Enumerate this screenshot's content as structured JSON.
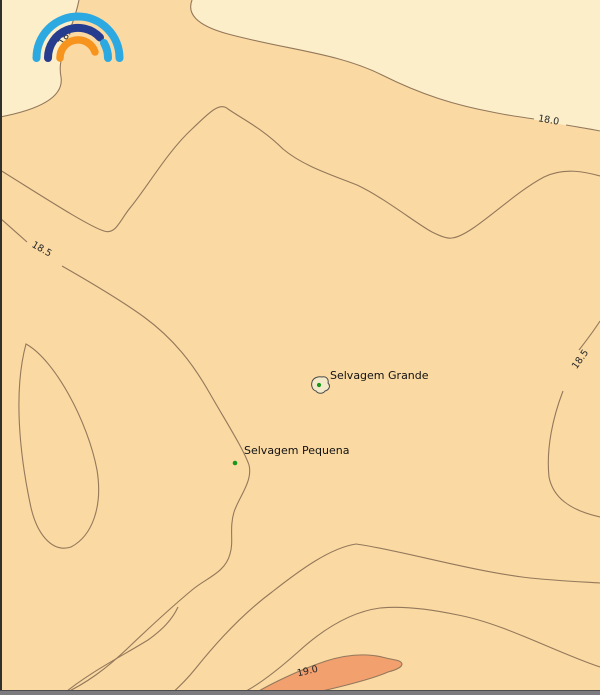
{
  "colors": {
    "band_below_18": "#FBEEC8",
    "band_18_19": "#FAD9A2",
    "band_above_19": "#F1A06E",
    "contour_line": "#93785B",
    "bottom_bar": "#7B7B80",
    "logo_cyan": "#2DA9E1",
    "logo_blue": "#263C8F",
    "logo_orange": "#F7941D",
    "place_dot_green": "#18991B"
  },
  "labels": {
    "contour": [
      {
        "value": "18.0",
        "location": "top-left, partially hidden behind logo"
      },
      {
        "value": "18.0",
        "location": "top-right"
      },
      {
        "value": "18.5",
        "location": "upper-left"
      },
      {
        "value": "18.5",
        "location": "right-edge"
      },
      {
        "value": "19.0",
        "location": "bottom"
      }
    ],
    "places": [
      {
        "name": "Selvagem Grande"
      },
      {
        "name": "Selvagem Pequena"
      }
    ]
  },
  "chart_data": {
    "type": "contour-map",
    "contour_levels": [
      18.0,
      18.5,
      19.0
    ],
    "bands": [
      {
        "range": "below 18.0",
        "color": "#FBEEC8"
      },
      {
        "range": "18.0 to 19.0",
        "color": "#FAD9A2"
      },
      {
        "range": "above 19.0",
        "color": "#F1A06E"
      }
    ],
    "places": [
      {
        "name": "Selvagem Grande",
        "marker": "island-outline-with-green-dot"
      },
      {
        "name": "Selvagem Pequena",
        "marker": "green-dot"
      }
    ]
  },
  "icons": {
    "logo": "rainbow-arcs-logo"
  }
}
